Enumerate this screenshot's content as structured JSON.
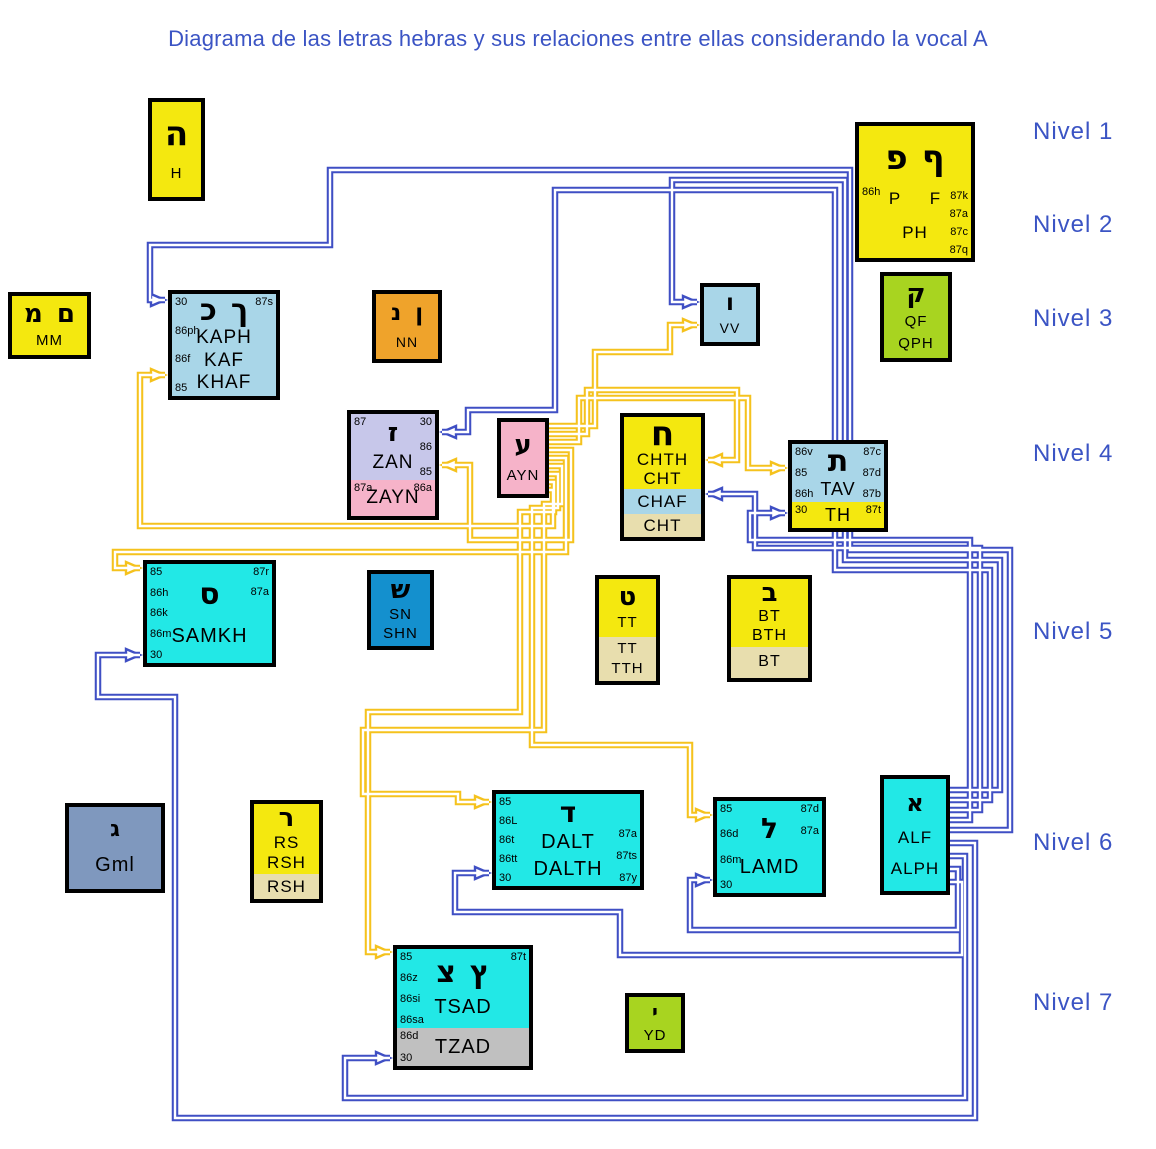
{
  "title": "Diagrama de las letras hebras y sus relaciones entre ellas considerando la vocal A",
  "levels": [
    "Nivel 1",
    "Nivel 2",
    "Nivel 3",
    "Nivel 4",
    "Nivel 5",
    "Nivel 6",
    "Nivel 7"
  ],
  "colors": {
    "yellow": "#F4E80F",
    "orange": "#EFA32B",
    "lightblue": "#A9D6E8",
    "green": "#A8D420",
    "lavender": "#C7C7EA",
    "pink": "#F6B3C9",
    "cyan": "#22E8E6",
    "medblue": "#1490CE",
    "slate": "#7F98BE",
    "cream": "#E8DEAE",
    "gray": "#C0C0C0",
    "line_blue": "#3F4FC4",
    "line_yellow": "#F5C21D",
    "title_blue": "#3B54C4"
  },
  "boxes": [
    {
      "id": "h",
      "bands": [
        {
          "bg": "yellow",
          "hebrew": [
            "ה"
          ],
          "center": [
            "H"
          ]
        }
      ]
    },
    {
      "id": "ph",
      "bands": [
        {
          "bg": "yellow",
          "left": [
            "86h"
          ],
          "right": [
            "87k",
            "87a",
            "87c",
            "87q"
          ],
          "hebrew": [
            "פ",
            "ף"
          ],
          "center": [
            "P   F",
            "PH"
          ]
        }
      ]
    },
    {
      "id": "mm",
      "bands": [
        {
          "bg": "yellow",
          "hebrew": [
            "מ",
            "ם"
          ],
          "center": [
            "MM"
          ]
        }
      ]
    },
    {
      "id": "kaph",
      "bands": [
        {
          "bg": "lightblue",
          "left": [
            "30",
            "86ph",
            "86f",
            "85"
          ],
          "right": [
            "87s"
          ],
          "hebrew": [
            "כ",
            "ך"
          ],
          "center": [
            "KAPH",
            "KAF",
            "KHAF"
          ]
        }
      ]
    },
    {
      "id": "nn",
      "bands": [
        {
          "bg": "orange",
          "hebrew": [
            "נ",
            "ן"
          ],
          "center": [
            "NN"
          ]
        }
      ]
    },
    {
      "id": "vv",
      "bands": [
        {
          "bg": "lightblue",
          "hebrew": [
            "ו"
          ],
          "center": [
            "VV"
          ]
        }
      ]
    },
    {
      "id": "qph",
      "bands": [
        {
          "bg": "green",
          "hebrew": [
            "ק"
          ],
          "center": [
            "QF",
            "QPH"
          ]
        }
      ]
    },
    {
      "id": "zan",
      "bands": [
        {
          "bg": "lavender",
          "left": [
            "87"
          ],
          "right": [
            "30",
            "86",
            "85"
          ],
          "hebrew": [
            "ז"
          ],
          "center": [
            "ZAN"
          ]
        },
        {
          "bg": "pink",
          "left": [
            "87a"
          ],
          "right": [
            "86a"
          ],
          "center": [
            "ZAYN"
          ]
        }
      ]
    },
    {
      "id": "ayn",
      "bands": [
        {
          "bg": "pink",
          "hebrew": [
            "ע"
          ],
          "center": [
            "AYN"
          ]
        }
      ]
    },
    {
      "id": "chth",
      "bands": [
        {
          "bg": "yellow",
          "hebrew": [
            "ח"
          ],
          "center": [
            "CHTH",
            "CHT"
          ]
        },
        {
          "bg": "lightblue",
          "center": [
            "CHAF"
          ]
        },
        {
          "bg": "cream",
          "center": [
            "CHT"
          ]
        }
      ]
    },
    {
      "id": "tav",
      "bands": [
        {
          "bg": "lightblue",
          "left": [
            "86v",
            "85",
            "86h"
          ],
          "right": [
            "87c",
            "87d",
            "87b"
          ],
          "hebrew": [
            "ת"
          ],
          "center": [
            "TAV"
          ]
        },
        {
          "bg": "yellow",
          "left": [
            "30"
          ],
          "right": [
            "87t"
          ],
          "center": [
            "TH"
          ]
        }
      ]
    },
    {
      "id": "samkh",
      "bands": [
        {
          "bg": "cyan",
          "left": [
            "85",
            "86h",
            "86k",
            "86m",
            "30"
          ],
          "right": [
            "87r",
            "87a"
          ],
          "hebrew": [
            "ס"
          ],
          "center": [
            "SAMKH"
          ]
        }
      ]
    },
    {
      "id": "shn",
      "bands": [
        {
          "bg": "medblue",
          "hebrew": [
            "ש"
          ],
          "center": [
            "SN",
            "SHN"
          ]
        }
      ]
    },
    {
      "id": "tt",
      "bands": [
        {
          "bg": "yellow",
          "hebrew": [
            "ט"
          ],
          "center": [
            "TT"
          ]
        },
        {
          "bg": "cream",
          "center": [
            "TT",
            "TTH"
          ]
        }
      ]
    },
    {
      "id": "bt",
      "bands": [
        {
          "bg": "yellow",
          "hebrew": [
            "ב"
          ],
          "center": [
            "BT",
            "BTH"
          ]
        },
        {
          "bg": "cream",
          "center": [
            "BT"
          ]
        }
      ]
    },
    {
      "id": "gml",
      "bands": [
        {
          "bg": "slate",
          "hebrew": [
            "ג"
          ],
          "center": [
            "Gml"
          ]
        }
      ]
    },
    {
      "id": "rsh",
      "bands": [
        {
          "bg": "yellow",
          "hebrew": [
            "ר"
          ],
          "center": [
            "RS",
            "RSH"
          ]
        },
        {
          "bg": "cream",
          "center": [
            "RSH"
          ]
        }
      ]
    },
    {
      "id": "dalt",
      "bands": [
        {
          "bg": "cyan",
          "left": [
            "85",
            "86L",
            "86t",
            "86tt",
            "30"
          ],
          "right": [
            "87a",
            "87ts",
            "87y"
          ],
          "hebrew": [
            "ד"
          ],
          "center": [
            "DALT",
            "DALTH"
          ]
        }
      ]
    },
    {
      "id": "lamd",
      "bands": [
        {
          "bg": "cyan",
          "left": [
            "85",
            "86d",
            "86m",
            "30"
          ],
          "right": [
            "87d",
            "87a"
          ],
          "hebrew": [
            "ל"
          ],
          "center": [
            "LAMD"
          ]
        }
      ]
    },
    {
      "id": "alf",
      "bands": [
        {
          "bg": "cyan",
          "hebrew": [
            "א"
          ],
          "center": [
            "ALF",
            "ALPH"
          ]
        }
      ]
    },
    {
      "id": "tsad",
      "bands": [
        {
          "bg": "cyan",
          "left": [
            "85",
            "86z",
            "86si",
            "86sa"
          ],
          "right": [
            "87t"
          ],
          "hebrew": [
            "צ",
            "ץ"
          ],
          "center": [
            "TSAD"
          ]
        },
        {
          "bg": "gray",
          "left": [
            "86d",
            "30"
          ],
          "center": [
            "TZAD"
          ]
        }
      ]
    },
    {
      "id": "yd",
      "bands": [
        {
          "bg": "green",
          "hebrew": [
            "י"
          ],
          "center": [
            "YD"
          ]
        }
      ]
    }
  ],
  "connections": [
    {
      "from": "ayn",
      "to": "vv",
      "color": "yellow"
    },
    {
      "from": "ayn",
      "to": "chth",
      "color": "yellow"
    },
    {
      "from": "ayn",
      "to": "tav",
      "color": "yellow"
    },
    {
      "from": "ayn",
      "to": "zan",
      "color": "yellow"
    },
    {
      "from": "ayn",
      "to": "samkh",
      "color": "yellow"
    },
    {
      "from": "ayn",
      "to": "dalt",
      "color": "yellow"
    },
    {
      "from": "ayn",
      "to": "lamd",
      "color": "yellow"
    },
    {
      "from": "ayn",
      "to": "tsad",
      "color": "yellow"
    },
    {
      "from": "ayn",
      "to": "kaph",
      "color": "yellow"
    },
    {
      "from": "alf",
      "to": "vv",
      "color": "blue"
    },
    {
      "from": "alf",
      "to": "zan",
      "color": "blue"
    },
    {
      "from": "alf",
      "to": "chth",
      "color": "blue"
    },
    {
      "from": "alf",
      "to": "tav",
      "color": "blue"
    },
    {
      "from": "alf",
      "to": "kaph",
      "color": "blue"
    },
    {
      "from": "alf",
      "to": "samkh",
      "color": "blue"
    },
    {
      "from": "alf",
      "to": "tsad",
      "color": "blue"
    },
    {
      "from": "alf",
      "to": "lamd",
      "color": "blue"
    },
    {
      "from": "alf",
      "to": "dalt",
      "color": "blue"
    }
  ]
}
